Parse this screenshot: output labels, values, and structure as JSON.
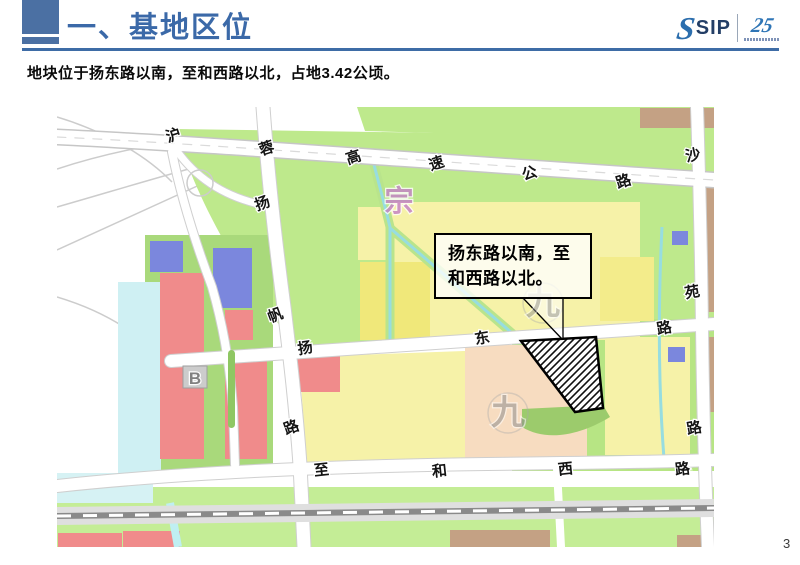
{
  "slide": {
    "title": "一、基地区位",
    "subtitle": "地块位于扬东路以南，至和西路以北，占地3.42公顷。",
    "page_number": "3"
  },
  "logo": {
    "s_mark": "S",
    "name": "SIP",
    "anniversary": "25"
  },
  "callout": {
    "lines": [
      "扬东路以南，至",
      "和西路以北。"
    ]
  },
  "map": {
    "road_names": {
      "highway": "沪蓉高速公路",
      "west_vertical": "扬帆路",
      "east_vertical": "沙苑路",
      "middle_horizontal": "扬东路",
      "bottom_horizontal": "至和西路"
    },
    "labels": [
      {
        "t": "沪",
        "x": 118,
        "y": 33,
        "r": -18
      },
      {
        "t": "蓉",
        "x": 211,
        "y": 46,
        "r": -18
      },
      {
        "t": "高",
        "x": 298,
        "y": 55,
        "r": -18
      },
      {
        "t": "速",
        "x": 381,
        "y": 61,
        "r": -18
      },
      {
        "t": "公",
        "x": 474,
        "y": 71,
        "r": -18
      },
      {
        "t": "路",
        "x": 568,
        "y": 79,
        "r": -18
      },
      {
        "t": "沙",
        "x": 637,
        "y": 53,
        "r": -12
      },
      {
        "t": "扬",
        "x": 207,
        "y": 101,
        "r": -20
      },
      {
        "t": "帆",
        "x": 220,
        "y": 213,
        "r": -20
      },
      {
        "t": "路",
        "x": 236,
        "y": 325,
        "r": -20
      },
      {
        "t": "苑",
        "x": 636,
        "y": 190,
        "r": -10
      },
      {
        "t": "路",
        "x": 638,
        "y": 326,
        "r": -10
      },
      {
        "t": "扬",
        "x": 249,
        "y": 246,
        "r": -10
      },
      {
        "t": "东",
        "x": 426,
        "y": 236,
        "r": -10
      },
      {
        "t": "路",
        "x": 608,
        "y": 226,
        "r": -10
      },
      {
        "t": "至",
        "x": 265,
        "y": 368,
        "r": -6
      },
      {
        "t": "和",
        "x": 383,
        "y": 369,
        "r": -6
      },
      {
        "t": "西",
        "x": 509,
        "y": 367,
        "r": -6
      },
      {
        "t": "路",
        "x": 626,
        "y": 367,
        "r": -6
      },
      {
        "t": "宗",
        "x": 342,
        "y": 104,
        "size": 29,
        "color": "#c47fc9",
        "opacity": 0.8
      },
      {
        "t": "九",
        "x": 486,
        "y": 207,
        "size": 34,
        "color": "#8f8f8f",
        "opacity": 0.5
      },
      {
        "t": "九",
        "x": 451,
        "y": 317,
        "size": 34,
        "color": "#8f8f8f",
        "opacity": 0.55
      },
      {
        "t": "B",
        "x": 138,
        "y": 277,
        "size": 17,
        "color": "#7d7d7d",
        "opacity": 0.95
      }
    ]
  },
  "colors": {
    "header_blue": "#4B70A3",
    "title_blue": "#3B69A8",
    "rule_blue": "#3E6CA6",
    "logo_navy": "#233E66",
    "logo_blue": "#2C6EAD"
  }
}
